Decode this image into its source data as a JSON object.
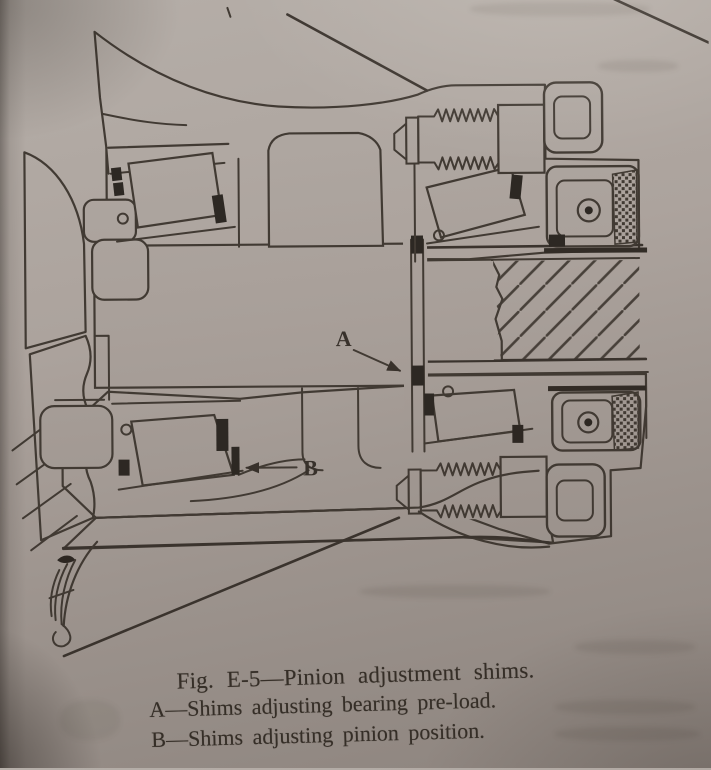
{
  "figure": {
    "caption": "Fig. E-5—Pinion adjustment shims.",
    "legend_a": "A—Shims adjusting bearing pre-load.",
    "legend_b": "B—Shims adjusting pinion position.",
    "callout_a": "A",
    "callout_b": "B"
  },
  "colors": {
    "paper": "#aba29c",
    "ink": "#3c352e",
    "shim_fill": "#27221d"
  }
}
